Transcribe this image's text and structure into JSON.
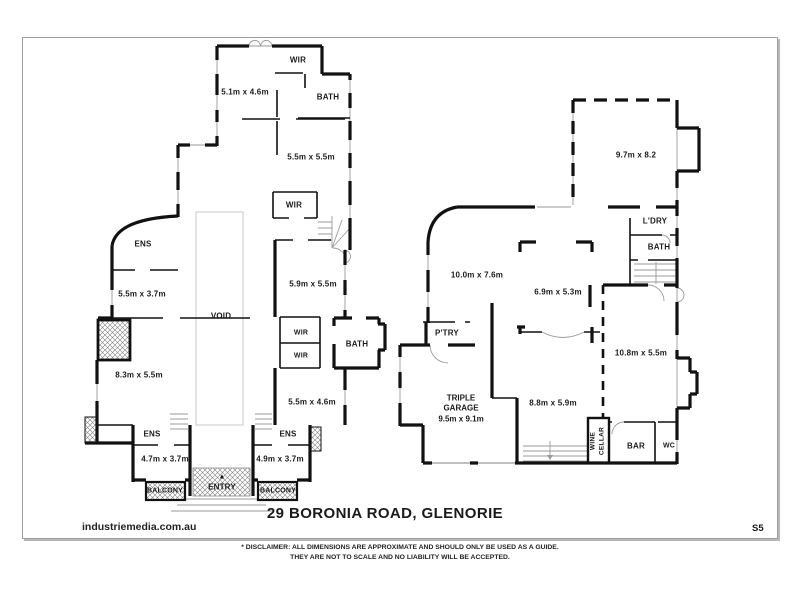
{
  "page": {
    "title": "29 BORONIA ROAD, GLENORIE",
    "watermark": "industriemedia.com.au",
    "sheet_code": "S5",
    "disclaimer_line1": "* DISCLAIMER: ALL DIMENSIONS ARE APPROXIMATE AND SHOULD ONLY BE USED AS A GUIDE.",
    "disclaimer_line2": "THEY ARE NOT TO SCALE AND NO LIABILITY WILL BE ACCEPTED."
  },
  "colors": {
    "wall": "#111111",
    "detail": "#9a9a9a",
    "text": "#1a1a1a"
  },
  "floorplan": {
    "upper": {
      "wir_top": "WIR",
      "dim_bed1": "5.1m x 4.6m",
      "bath_top": "BATH",
      "dim_bed2": "5.5m x 5.5m",
      "wir_mid": "WIR",
      "ens_left": "ENS",
      "dim_bed3": "5.5m x 3.7m",
      "dim_bed4": "5.9m x 5.5m",
      "void": "VOID",
      "wir_a": "WIR",
      "wir_b": "WIR",
      "bath_mid": "BATH",
      "dim_bed5": "8.3m x 5.5m",
      "dim_bed6": "5.5m x 4.6m",
      "ens_bottom_left": "ENS",
      "ens_bottom_right": "ENS",
      "dim_bed7": "4.7m x 3.7m",
      "dim_bed8": "4.9m x 3.7m",
      "balcony_left": "BALCONY",
      "entry": "ENTRY",
      "entry_arrow": "▲",
      "balcony_right": "BALCONY"
    },
    "ground": {
      "dim_living1": "9.7m x 8.2",
      "ldry": "L'DRY",
      "bath": "BATH",
      "dim_living2": "10.0m x 7.6m",
      "dim_family": "6.9m x 5.3m",
      "ptry": "P'TRY",
      "dim_rumpus": "10.8m x 5.5m",
      "garage_line1": "TRIPLE",
      "garage_line2": "GARAGE",
      "garage_line3": "9.5m x 9.1m",
      "dim_kitchen": "8.8m x 5.9m",
      "wine_line1": "WINE",
      "wine_line2": "CELLAR",
      "bar": "BAR",
      "wc": "WC"
    }
  }
}
